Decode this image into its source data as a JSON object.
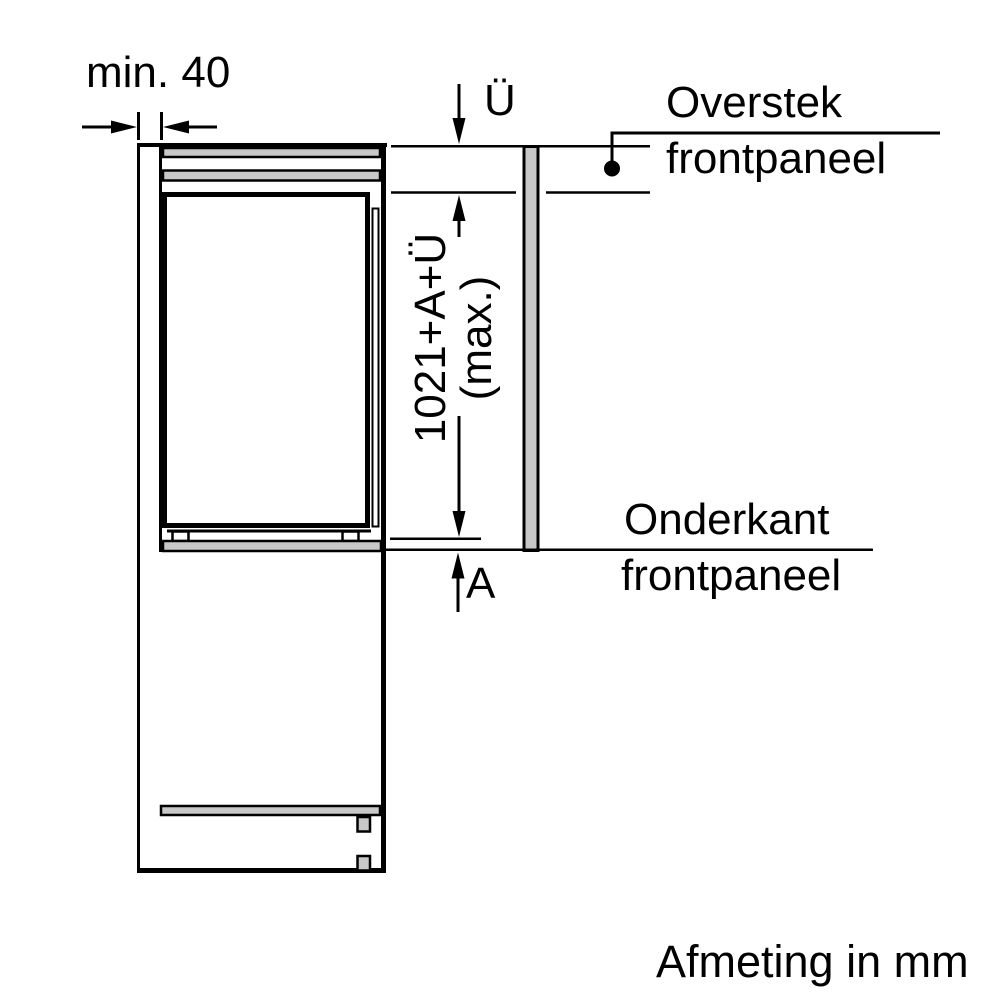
{
  "diagram": {
    "type": "appliance-built-in-installation-side-section",
    "unit_note": "Afmeting in mm",
    "dimensions": {
      "min_gap": "min. 40",
      "top_overhang_symbol": "Ü",
      "max_height_line1": "1021+A+Ü",
      "max_height_line2": "(max.)",
      "bottom_overhang_symbol": "A"
    },
    "callouts": {
      "overstek_line1": "Overstek",
      "overstek_line2": "frontpaneel",
      "onderkant_line1": "Onderkant",
      "onderkant_line2": "frontpaneel"
    },
    "colors": {
      "line": "#000000",
      "panel_fill": "#c8c8c8",
      "background": "#ffffff"
    }
  }
}
